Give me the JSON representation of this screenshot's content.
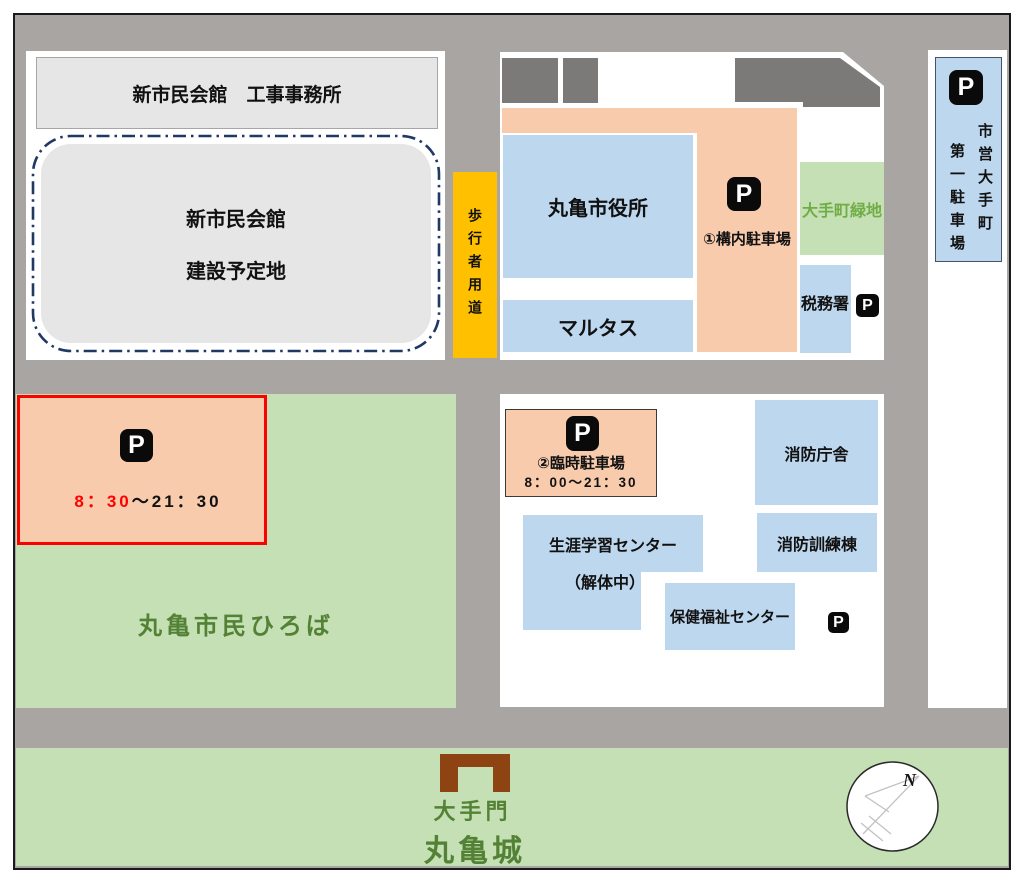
{
  "colors": {
    "road": "#a8a5a3",
    "building_blue": "#bdd7ee",
    "parking_peach": "#f8cbad",
    "green_area": "#c5e0b4",
    "pedestrian_yellow": "#ffc000",
    "dark_building": "#7c7a78",
    "planned_site_gray": "#e7e6e6",
    "highlight_red": "#ff0000",
    "dashed_border_navy": "#1f3864",
    "green_text_dark": "#538135",
    "green_text_light": "#70ad47",
    "gate_brown": "#8e4412"
  },
  "legend": {
    "p_symbol": "P"
  },
  "nw_block": {
    "office_label": "新市民会館　工事事務所",
    "site_line1": "新市民会館",
    "site_line2": "建設予定地"
  },
  "pedestrian_path": {
    "label": "歩行者用道"
  },
  "city_hall_block": {
    "city_hall": "丸亀市役所",
    "marutas": "マルタス",
    "lot1_label": "①構内駐車場",
    "green_space": "大手町緑地",
    "tax_office": "税務署"
  },
  "municipal_lot": {
    "col_right": "市営大手町",
    "col_left": "第一駐車場"
  },
  "plaza_block": {
    "hours_red": "8：30",
    "hours_black": "～21：30",
    "plaza": "丸亀市民ひろば"
  },
  "south_block": {
    "lot2_label": "②臨時駐車場",
    "lot2_hours": "8：00～21：30",
    "fire_hq": "消防庁舎",
    "learning_center": "生涯学習センター",
    "demolition": "（解体中）",
    "fire_training": "消防訓練棟",
    "health_center": "保健福祉センター"
  },
  "castle": {
    "gate": "大手門",
    "castle": "丸亀城",
    "compass_n": "N"
  }
}
